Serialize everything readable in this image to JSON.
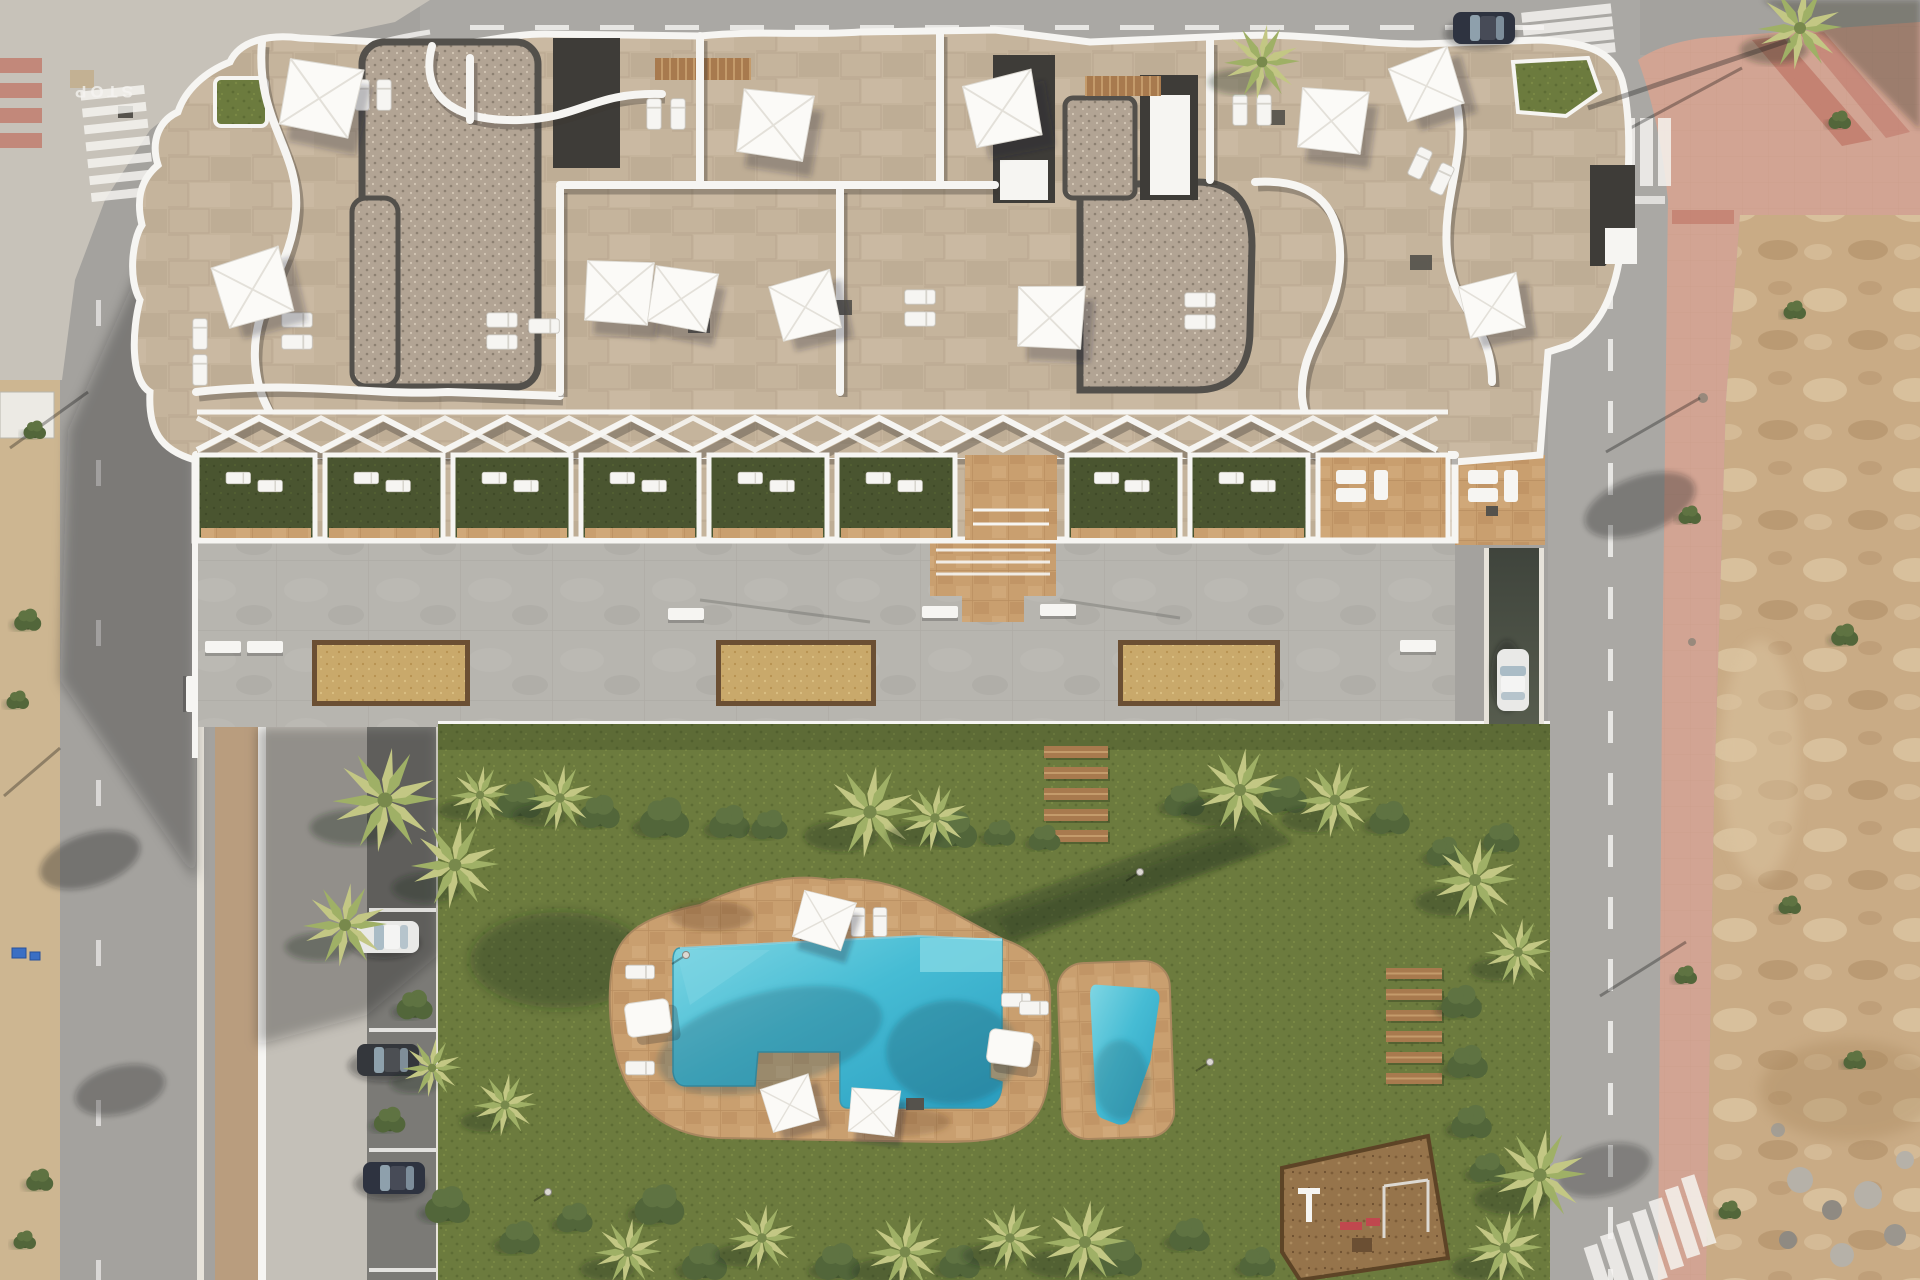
{
  "meta": {
    "title": "Aerial 3D architectural render — residential apartment complex with communal pool garden",
    "view": "top-down drone view, afternoon sun from north-east, shadows cast to south-west"
  },
  "road_markings": {
    "stop_text": "STOP"
  },
  "palette": {
    "roadBase": "#a4a29e",
    "roadLight": "#aaa8a4",
    "sidewalkWedge": "#c7c2b9",
    "pinkPlaza": "#d2a493",
    "pinkStripe": "#c0796a",
    "dirtBase": "#c9ab85",
    "dirtLight": "#dcc5a1",
    "dirtDark": "#ab8a61",
    "sandStrip": "#cdb691",
    "promenade": "#c4c0b8",
    "tanWalk": "#b99d7e",
    "parking": "#7b7a76",
    "curb": "#e7e3da",
    "white": "#f6f5f2",
    "plaza": "#b7b5af",
    "plazaLine": "#a5a29b",
    "stone": "#c5b49c",
    "stoneLine": "#a8937a",
    "gravelBase": "#b2a494",
    "gravelDot1": "#8c8071",
    "gravelDot2": "#d3c7b5",
    "darkRoof": "#3e3c38",
    "turf": "#6c7b3e",
    "turfDot": "#5d6c34",
    "turfLight": "#7a8945",
    "turfDark": "#4a5530",
    "turfDarkDot": "#3f4a27",
    "deck": "#c99f6f",
    "deckLine": "#a97f52",
    "poolLight": "#7fd6e3",
    "pool": "#46bcd4",
    "poolDeep": "#2b9ec0",
    "mulch": "#96744b",
    "mulchDark": "#5d4426",
    "wood": "#a87a4e",
    "woodLight": "#c49b6b",
    "palmLight": "#c3c784",
    "palmMid": "#9fb066",
    "palmDark": "#78894c",
    "bush1": "#43562f",
    "bush2": "#52663a",
    "bush3": "#5f7342",
    "shadow": "rgba(25,28,35,0.30)",
    "greenShadow": "rgba(28,40,20,0.33)",
    "carWhite": "#e9e9e7",
    "carDark": "#34373c",
    "carBlue": "#2e3340",
    "glass": "#9fb4c0",
    "red": "#c0484e",
    "ramp1": "#3f443c",
    "ramp2": "#646a58"
  },
  "objects": {
    "sails": [
      {
        "x": 318,
        "y": 95,
        "s": 1.0,
        "r": 15
      },
      {
        "x": 250,
        "y": 287,
        "s": 0.95,
        "r": -12
      },
      {
        "x": 616,
        "y": 290,
        "s": 0.9,
        "r": 8
      },
      {
        "x": 772,
        "y": 122,
        "s": 0.95,
        "r": 12
      },
      {
        "x": 1000,
        "y": 108,
        "s": 0.95,
        "r": -8
      },
      {
        "x": 680,
        "y": 296,
        "s": 0.85,
        "r": 14
      },
      {
        "x": 803,
        "y": 305,
        "s": 0.85,
        "r": -10
      },
      {
        "x": 1048,
        "y": 315,
        "s": 0.9,
        "r": 6
      },
      {
        "x": 1330,
        "y": 118,
        "s": 0.9,
        "r": 10
      },
      {
        "x": 1424,
        "y": 84,
        "s": 0.85,
        "r": -15
      },
      {
        "x": 1490,
        "y": 305,
        "s": 0.8,
        "r": -8
      },
      {
        "x": 822,
        "y": 918,
        "s": 0.72,
        "r": 20
      },
      {
        "x": 788,
        "y": 1103,
        "s": 0.68,
        "r": -12
      },
      {
        "x": 872,
        "y": 1110,
        "s": 0.66,
        "r": 10
      }
    ],
    "roof_loungers": [
      {
        "x": 362,
        "y": 95,
        "r": 0
      },
      {
        "x": 384,
        "y": 95,
        "r": 0
      },
      {
        "x": 297,
        "y": 320,
        "r": 90
      },
      {
        "x": 297,
        "y": 342,
        "r": 90
      },
      {
        "x": 200,
        "y": 334,
        "r": 0
      },
      {
        "x": 200,
        "y": 370,
        "r": 0
      },
      {
        "x": 502,
        "y": 320,
        "r": 90
      },
      {
        "x": 502,
        "y": 342,
        "r": 90
      },
      {
        "x": 544,
        "y": 326,
        "r": 90
      },
      {
        "x": 654,
        "y": 114,
        "r": 0
      },
      {
        "x": 678,
        "y": 114,
        "r": 0
      },
      {
        "x": 920,
        "y": 297,
        "r": 90
      },
      {
        "x": 920,
        "y": 319,
        "r": 90
      },
      {
        "x": 1240,
        "y": 110,
        "r": 0
      },
      {
        "x": 1264,
        "y": 110,
        "r": 0
      },
      {
        "x": 1420,
        "y": 163,
        "r": 25
      },
      {
        "x": 1442,
        "y": 179,
        "r": 25
      },
      {
        "x": 1200,
        "y": 300,
        "r": 90
      },
      {
        "x": 1200,
        "y": 322,
        "r": 90
      }
    ],
    "roof_tables": [
      {
        "x": 300,
        "y": 108
      },
      {
        "x": 830,
        "y": 300
      },
      {
        "x": 1263,
        "y": 110
      },
      {
        "x": 1410,
        "y": 255
      },
      {
        "x": 688,
        "y": 318
      }
    ],
    "terrace_units": [
      {
        "x": 197,
        "w": 118,
        "type": "turf"
      },
      {
        "x": 325,
        "w": 118,
        "type": "turf"
      },
      {
        "x": 453,
        "w": 118,
        "type": "turf"
      },
      {
        "x": 581,
        "w": 118,
        "type": "turf"
      },
      {
        "x": 709,
        "w": 118,
        "type": "turf"
      },
      {
        "x": 837,
        "w": 118,
        "type": "turf"
      },
      {
        "x": 965,
        "w": 92,
        "type": "corridor"
      },
      {
        "x": 1067,
        "w": 113,
        "type": "turf"
      },
      {
        "x": 1190,
        "w": 118,
        "type": "turf"
      },
      {
        "x": 1318,
        "w": 130,
        "type": "stone"
      }
    ],
    "pergola": {
      "x0": 197,
      "x1": 1448,
      "yTop": 418,
      "yBot": 450,
      "step": 62
    },
    "planters": [
      {
        "x": 312,
        "y": 640,
        "w": 158,
        "h": 66
      },
      {
        "x": 716,
        "y": 640,
        "w": 160,
        "h": 66
      },
      {
        "x": 1118,
        "y": 640,
        "w": 162,
        "h": 66
      }
    ],
    "plaza_benches": [
      {
        "x": 205,
        "y": 641,
        "r": 0
      },
      {
        "x": 247,
        "y": 641,
        "r": 0
      },
      {
        "x": 668,
        "y": 608,
        "r": 0
      },
      {
        "x": 922,
        "y": 606,
        "r": 0
      },
      {
        "x": 1040,
        "y": 604,
        "r": 0
      },
      {
        "x": 198,
        "y": 676,
        "r": 90
      },
      {
        "x": 1400,
        "y": 640,
        "r": 0
      }
    ],
    "planks_a": {
      "x": 1044,
      "y": 746,
      "w": 64,
      "h": 12,
      "step": 21,
      "count": 5
    },
    "planks_b": {
      "x": 1386,
      "y": 968,
      "w": 56,
      "h": 11,
      "step": 21,
      "count": 6
    },
    "parking": {
      "lines": [
        908,
        1028,
        1148,
        1268
      ],
      "cars": [
        {
          "x": 388,
          "y": 937,
          "r": 0,
          "color": "carWhite"
        },
        {
          "x": 388,
          "y": 1060,
          "r": 0,
          "color": "carDark"
        },
        {
          "x": 394,
          "y": 1178,
          "r": 0,
          "color": "carBlue"
        }
      ]
    },
    "street_cars": [
      {
        "x": 1484,
        "y": 28,
        "r": 0,
        "color": "carBlue"
      },
      {
        "x": 1513,
        "y": 680,
        "r": 90,
        "color": "carWhite"
      }
    ],
    "deck_loungers": [
      {
        "x": 640,
        "y": 972,
        "r": 90
      },
      {
        "x": 640,
        "y": 1068,
        "r": 90
      },
      {
        "x": 858,
        "y": 922,
        "r": 0
      },
      {
        "x": 880,
        "y": 922,
        "r": 0
      },
      {
        "x": 1016,
        "y": 1000,
        "r": 90
      },
      {
        "x": 1034,
        "y": 1008,
        "r": 90
      }
    ],
    "daybeds": [
      {
        "x": 648,
        "y": 1018,
        "r": -8
      },
      {
        "x": 1010,
        "y": 1048,
        "r": 8
      }
    ],
    "deck_tables": [
      {
        "x": 800,
        "y": 928
      },
      {
        "x": 906,
        "y": 1098
      }
    ],
    "garden": {
      "palms": [
        {
          "x": 385,
          "y": 800,
          "s": 1.25
        },
        {
          "x": 455,
          "y": 865,
          "s": 1.05
        },
        {
          "x": 345,
          "y": 925,
          "s": 1.0
        },
        {
          "x": 480,
          "y": 795,
          "s": 0.7
        },
        {
          "x": 560,
          "y": 798,
          "s": 0.8
        },
        {
          "x": 870,
          "y": 812,
          "s": 1.1
        },
        {
          "x": 935,
          "y": 818,
          "s": 0.8
        },
        {
          "x": 1240,
          "y": 790,
          "s": 1.0
        },
        {
          "x": 1335,
          "y": 800,
          "s": 0.9
        },
        {
          "x": 1475,
          "y": 880,
          "s": 1.0
        },
        {
          "x": 1518,
          "y": 952,
          "s": 0.8
        },
        {
          "x": 1540,
          "y": 1175,
          "s": 1.1
        },
        {
          "x": 1505,
          "y": 1248,
          "s": 0.9
        },
        {
          "x": 1085,
          "y": 1242,
          "s": 1.0
        },
        {
          "x": 1010,
          "y": 1238,
          "s": 0.8
        },
        {
          "x": 905,
          "y": 1252,
          "s": 0.9
        },
        {
          "x": 762,
          "y": 1238,
          "s": 0.8
        },
        {
          "x": 628,
          "y": 1252,
          "s": 0.8
        },
        {
          "x": 505,
          "y": 1105,
          "s": 0.75
        },
        {
          "x": 432,
          "y": 1068,
          "s": 0.7
        }
      ],
      "bushes": [
        {
          "x": 520,
          "y": 800,
          "s": 1.0
        },
        {
          "x": 600,
          "y": 812,
          "s": 0.9
        },
        {
          "x": 665,
          "y": 818,
          "s": 1.1
        },
        {
          "x": 730,
          "y": 822,
          "s": 0.9
        },
        {
          "x": 770,
          "y": 825,
          "s": 0.8
        },
        {
          "x": 955,
          "y": 830,
          "s": 1.0
        },
        {
          "x": 1000,
          "y": 833,
          "s": 0.7
        },
        {
          "x": 1185,
          "y": 800,
          "s": 0.9
        },
        {
          "x": 1285,
          "y": 795,
          "s": 1.0
        },
        {
          "x": 1390,
          "y": 818,
          "s": 0.9
        },
        {
          "x": 1445,
          "y": 852,
          "s": 0.8
        },
        {
          "x": 1462,
          "y": 1002,
          "s": 0.9
        },
        {
          "x": 1468,
          "y": 1062,
          "s": 0.9
        },
        {
          "x": 1472,
          "y": 1122,
          "s": 0.9
        },
        {
          "x": 1488,
          "y": 1168,
          "s": 0.8
        },
        {
          "x": 448,
          "y": 1205,
          "s": 1.0
        },
        {
          "x": 520,
          "y": 1238,
          "s": 0.9
        },
        {
          "x": 575,
          "y": 1218,
          "s": 0.8
        },
        {
          "x": 660,
          "y": 1205,
          "s": 1.1
        },
        {
          "x": 705,
          "y": 1262,
          "s": 1.0
        },
        {
          "x": 838,
          "y": 1262,
          "s": 1.0
        },
        {
          "x": 960,
          "y": 1262,
          "s": 0.9
        },
        {
          "x": 1120,
          "y": 1258,
          "s": 1.0
        },
        {
          "x": 1190,
          "y": 1235,
          "s": 0.9
        },
        {
          "x": 1258,
          "y": 1262,
          "s": 0.8
        },
        {
          "x": 415,
          "y": 1005,
          "s": 0.8
        },
        {
          "x": 390,
          "y": 1120,
          "s": 0.7
        },
        {
          "x": 1045,
          "y": 838,
          "s": 0.7
        },
        {
          "x": 1502,
          "y": 838,
          "s": 0.8
        }
      ],
      "lamps": [
        {
          "x": 686,
          "y": 955
        },
        {
          "x": 1140,
          "y": 872
        },
        {
          "x": 548,
          "y": 1192
        },
        {
          "x": 1210,
          "y": 1062
        }
      ]
    },
    "left_strip_bushes": [
      {
        "x": 28,
        "y": 620,
        "s": 0.6
      },
      {
        "x": 18,
        "y": 700,
        "s": 0.5
      },
      {
        "x": 40,
        "y": 1180,
        "s": 0.6
      },
      {
        "x": 25,
        "y": 1240,
        "s": 0.5
      },
      {
        "x": 35,
        "y": 430,
        "s": 0.5
      }
    ],
    "dirt_weeds": [
      {
        "x": 1840,
        "y": 120,
        "s": 0.5
      },
      {
        "x": 1795,
        "y": 310,
        "s": 0.5
      },
      {
        "x": 1845,
        "y": 635,
        "s": 0.6
      },
      {
        "x": 1790,
        "y": 905,
        "s": 0.5
      },
      {
        "x": 1855,
        "y": 1060,
        "s": 0.5
      },
      {
        "x": 1730,
        "y": 1210,
        "s": 0.5
      },
      {
        "x": 1690,
        "y": 515,
        "s": 0.5
      },
      {
        "x": 1686,
        "y": 975,
        "s": 0.5
      }
    ],
    "zebras": [
      {
        "x": 1568,
        "y": 118,
        "w": 13,
        "h": 68,
        "dx": 18,
        "dy": 0,
        "count": 6,
        "rot": 0,
        "cx": 0,
        "cy": 0
      },
      {
        "x": 1523,
        "y": 8,
        "w": 90,
        "h": 10,
        "dx": 0,
        "dy": 13,
        "count": 4,
        "rot": -6,
        "cx": 1568,
        "cy": 28
      },
      {
        "x": 86,
        "y": 88,
        "w": 64,
        "h": 9,
        "dx": 0,
        "dy": 17,
        "count": 7,
        "rot": -6,
        "cx": 118,
        "cy": 145
      },
      {
        "x": 1590,
        "y": 1228,
        "w": 14,
        "h": 72,
        "dx": 19,
        "dy": -6,
        "count": 7,
        "rot": -18,
        "cx": 1650,
        "cy": 1258
      }
    ],
    "pink_crosswalk": {
      "x": 0,
      "y": 58,
      "w": 42,
      "h": 15,
      "step": 25,
      "count": 4
    },
    "dashes": {
      "top_road": {
        "x0": 470,
        "x1": 1540,
        "y": 25,
        "len": 34,
        "gap": 31,
        "horizontal": true
      },
      "right_road": {
        "y0": 215,
        "y1": 1270,
        "x": 1608,
        "len": 32,
        "gap": 30,
        "horizontal": false
      },
      "left_road": {
        "ys": [
          300,
          460,
          620,
          780,
          940,
          1100,
          1260
        ],
        "x": 96,
        "len": 26
      }
    },
    "pole_shadows": [
      [
        1742,
        68,
        1612,
        138
      ],
      [
        1700,
        398,
        1606,
        452
      ],
      [
        1686,
        942,
        1600,
        996
      ],
      [
        88,
        392,
        10,
        448
      ],
      [
        60,
        748,
        4,
        796
      ]
    ],
    "bins": [
      {
        "x": 12,
        "y": 948,
        "w": 14,
        "h": 10
      },
      {
        "x": 30,
        "y": 952,
        "w": 10,
        "h": 8
      }
    ]
  }
}
